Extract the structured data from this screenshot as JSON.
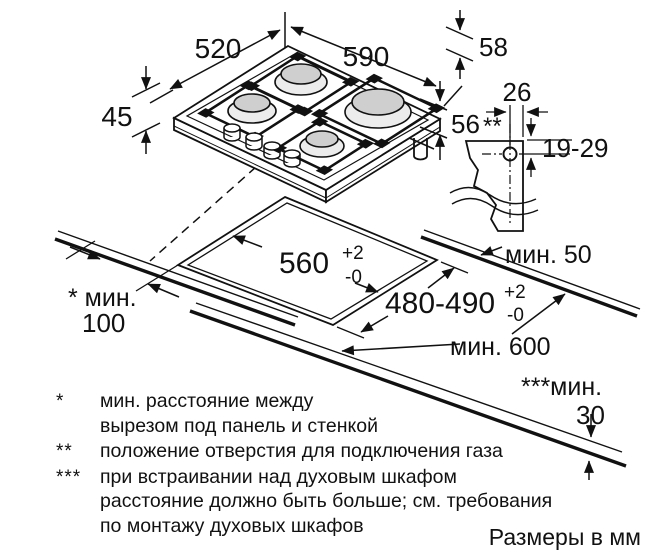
{
  "diagram": {
    "labels": {
      "d520": "520",
      "d590": "590",
      "d58": "58",
      "d45": "45",
      "d56": "56",
      "d26": "26",
      "d19_29": "19-29",
      "gas_marker": "**",
      "cutout_w": "560",
      "cutout_w_tol_p": "+2",
      "cutout_w_tol_m": "-0",
      "cutout_d": "480-490",
      "cutout_d_tol_p": "+2",
      "cutout_d_tol_m": "-0",
      "min50": "мин. 50",
      "min100_line1": "* мин.",
      "min100_line2": "100",
      "min600": "мин. 600",
      "min30_line1": "***мин.",
      "min30_line2": "30",
      "units": "Размеры в мм"
    },
    "footnotes": [
      {
        "marker": "*",
        "lines": [
          "мин. расстояние между",
          "вырезом под панель и стенкой",
          ""
        ]
      },
      {
        "marker": "**",
        "lines": [
          "положение отверстия для подключения газа",
          "",
          ""
        ]
      },
      {
        "marker": "***",
        "lines": [
          "при встраивании над духовым шкафом",
          "расстояние должно быть больше; см. требования",
          "по монтажу духовых шкафов"
        ]
      }
    ]
  }
}
